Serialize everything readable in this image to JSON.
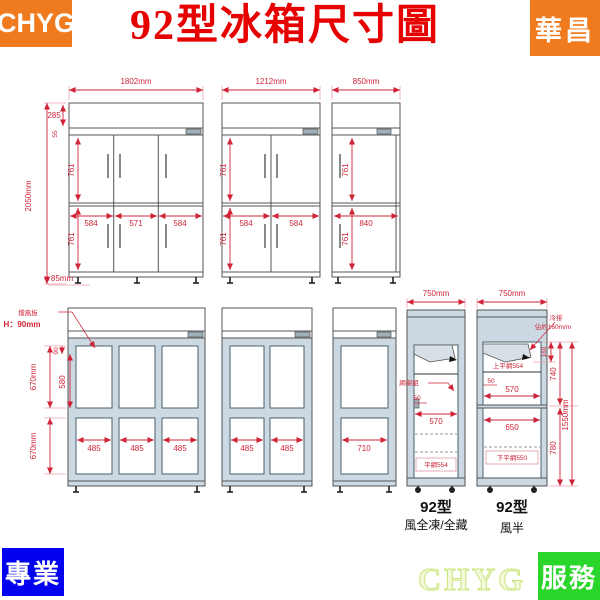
{
  "header": {
    "brand_left": "CHYG",
    "title": "92型冰箱尺寸圖",
    "brand_right": "華昌"
  },
  "footer": {
    "badge_left": "專業",
    "watermark": "CHYG",
    "badge_right": "服務"
  },
  "colors": {
    "accent_red": "#cf2438",
    "title_red": "#e60000",
    "badge_orange": "#f07a1e",
    "badge_blue": "#0202ee",
    "badge_green": "#2ad62a",
    "cabinet_blue": "#ccd9e2"
  },
  "front_views": {
    "six_door": {
      "width": "1802mm",
      "overall_height": "2050mm",
      "top_section": "285",
      "header_strip": "55",
      "upper_door_height": "761",
      "lower_door_height": "761",
      "door_widths": [
        "584",
        "571",
        "584"
      ],
      "leg_height": "85mm"
    },
    "four_door": {
      "width": "1212mm",
      "upper_door_height": "761",
      "lower_door_height": "761",
      "door_widths": [
        "584",
        "584"
      ]
    },
    "two_door": {
      "width": "850mm",
      "upper_door_height": "761",
      "lower_door_height": "761",
      "door_widths": [
        "840"
      ]
    }
  },
  "glass_views": {
    "six_window": {
      "baffle_label": "擋風板",
      "baffle_height": "H：90mm",
      "upper_section": "670mm",
      "lower_section": "670mm",
      "inner_top": "90",
      "inner_window": "580",
      "window_widths": [
        "485",
        "485",
        "485"
      ]
    },
    "four_window": {
      "window_widths": [
        "485",
        "485"
      ]
    },
    "two_window": {
      "window_widths": [
        "710"
      ]
    }
  },
  "side_views": {
    "full": {
      "width": "750mm",
      "shelf_label": "網架組",
      "gap": "50",
      "shelf_width": "570",
      "bottom_shelf": "平網554",
      "model": "92型",
      "variant": "風全凍/全藏"
    },
    "half": {
      "width": "750mm",
      "cooler_label": "冷排",
      "cooler_note": "佔約160m/m",
      "cooler_height": "160",
      "upper_height": "740",
      "total_height": "1550mm",
      "lower_height": "780",
      "upper_shelf": "上平網554",
      "gap": "50",
      "shelf_width": "570",
      "lower_width": "650",
      "bottom_shelf": "下平網550",
      "model": "92型",
      "variant": "風半"
    }
  }
}
